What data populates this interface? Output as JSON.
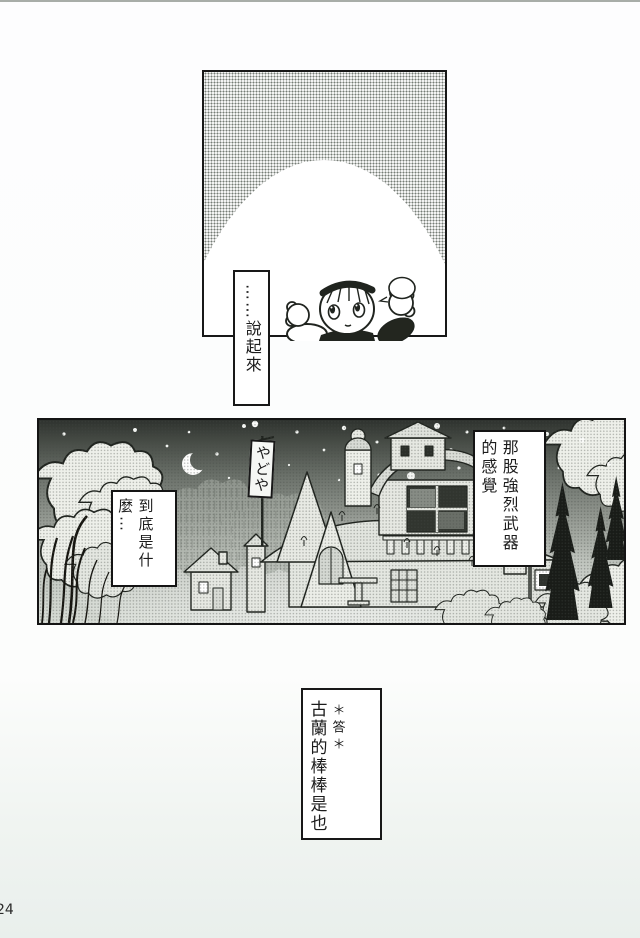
{
  "page": {
    "number": "24"
  },
  "colors": {
    "ink": "#1c1c1c",
    "paper": "#fcfdfc",
    "halftone_gray": "#767c76",
    "night_sky_dark": "#2e322e"
  },
  "panels": {
    "top": {
      "bubble_text": "……說起來"
    },
    "middle": {
      "banner_text": "やどや",
      "balloon_feeling": {
        "col1": "那股強烈武器",
        "col2": "的感覺"
      },
      "balloon_what": {
        "col1": "到底是什",
        "col2": "麼…"
      }
    },
    "bottom": {
      "marker": "＊答＊",
      "answer": "古蘭的棒棒是也"
    }
  }
}
